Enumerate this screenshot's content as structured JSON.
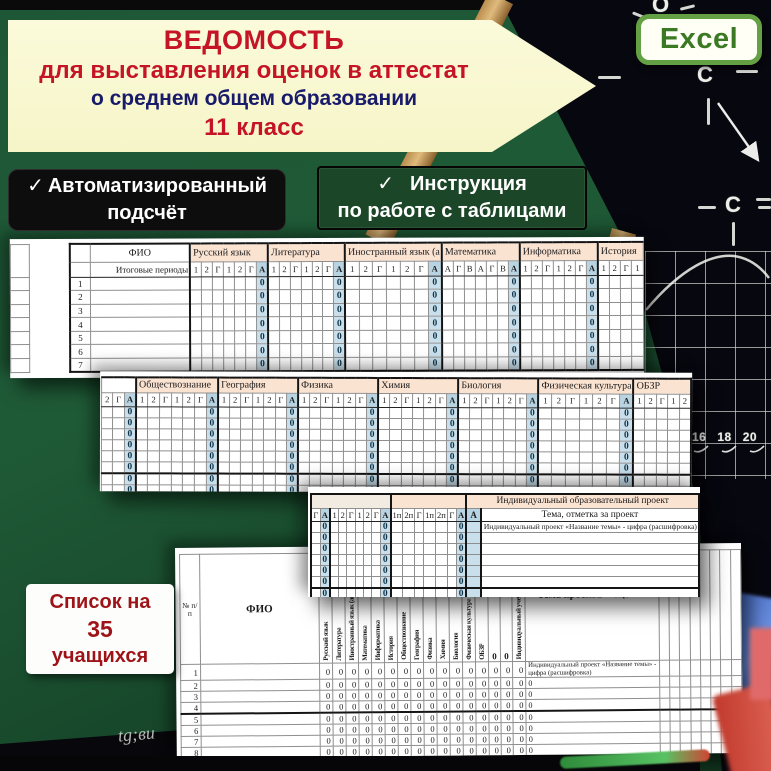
{
  "banner": {
    "line1": "ВЕДОМОСТЬ",
    "line2": "для выставления оценок в аттестат",
    "line3": "о среднем общем образовании",
    "line4": "11 класс"
  },
  "excel_badge": {
    "label": "Excel"
  },
  "feature_badges": {
    "auto": {
      "check": "✓",
      "line1": "Автоматизированный",
      "line2": "подсчёт"
    },
    "instruction": {
      "check": "✓",
      "line1": "Инструкция",
      "line2": "по работе с таблицами"
    }
  },
  "list_badge": {
    "line1": "Список на",
    "line2": "35",
    "line3": "учащихся"
  },
  "chalk": {
    "atom_o": "O",
    "atom_c1": "C",
    "atom_c2": "C",
    "axis_numbers": [
      "16",
      "18",
      "20"
    ],
    "handwriting": "tg;ви"
  },
  "sheet1": {
    "fio": "ФИО",
    "periods": "Итоговые периоды",
    "zero": "0",
    "groups": [
      {
        "name": "Русский язык",
        "cols": [
          "1",
          "2",
          "Г",
          "1",
          "2",
          "Г",
          "А"
        ]
      },
      {
        "name": "Литература",
        "cols": [
          "1",
          "2",
          "Г",
          "1",
          "2",
          "Г",
          "А"
        ]
      },
      {
        "name": "Иностранный язык (а",
        "cols": [
          "1",
          "2",
          "Г",
          "1",
          "2",
          "Г",
          "А"
        ]
      },
      {
        "name": "Математика",
        "cols": [
          "А",
          "Г",
          "В",
          "А",
          "Г",
          "В",
          "А"
        ]
      },
      {
        "name": "Информатика",
        "cols": [
          "1",
          "2",
          "Г",
          "1",
          "2",
          "Г",
          "А"
        ]
      },
      {
        "name": "История",
        "cols": [
          "1",
          "2",
          "Г",
          "1"
        ]
      }
    ],
    "row_numbers": [
      "1",
      "2",
      "3",
      "4",
      "5",
      "6",
      "7"
    ]
  },
  "sheet2": {
    "lead_cols": [
      "2",
      "Г",
      "А"
    ],
    "zero": "0",
    "rows": 8,
    "thick_after_row": 6,
    "groups": [
      {
        "name": "Обществознание",
        "cols": [
          "1",
          "2",
          "Г",
          "1",
          "2",
          "Г",
          "А"
        ]
      },
      {
        "name": "География",
        "cols": [
          "1",
          "2",
          "Г",
          "1",
          "2",
          "Г",
          "А"
        ]
      },
      {
        "name": "Физика",
        "cols": [
          "1",
          "2",
          "Г",
          "1",
          "2",
          "Г",
          "А"
        ]
      },
      {
        "name": "Химия",
        "cols": [
          "1",
          "2",
          "Г",
          "1",
          "2",
          "Г",
          "А"
        ]
      },
      {
        "name": "Биология",
        "cols": [
          "1",
          "2",
          "Г",
          "1",
          "2",
          "Г",
          "А"
        ]
      },
      {
        "name": "Физическая культура",
        "cols": [
          "1",
          "2",
          "Г",
          "1",
          "2",
          "Г",
          "А"
        ]
      },
      {
        "name": "ОБЗР",
        "cols": [
          "1",
          "2",
          "Г",
          "1",
          "2"
        ]
      }
    ]
  },
  "sheet3": {
    "section_title": "Индивидуальный образовательный проект",
    "lead_cols": [
      "Г",
      "А"
    ],
    "groups": [
      {
        "cols": [
          "1",
          "2",
          "Г",
          "1",
          "2",
          "Г",
          "А"
        ]
      },
      {
        "cols": [
          "1п",
          "2п",
          "Г",
          "1п",
          "2п",
          "Г",
          "А"
        ]
      }
    ],
    "avg_col": "А",
    "theme_header": "Тема, отметка за проект",
    "row1_text": "Индивидуальный проект «Название темы» - цифра (расшифровка)",
    "zero": "0",
    "rows": 8,
    "thick_after_row": 6
  },
  "sheet4": {
    "num_header": "№ п/п",
    "fio_header": "ФИО",
    "vertical_headers": [
      "Русский язык",
      "Литература",
      "Иностранный язык (ан",
      "Математика",
      "Информатика",
      "История",
      "Обществознание",
      "География",
      "Физика",
      "Химия",
      "Биология",
      "Физическая культура",
      "ОБЗР",
      "0",
      "0",
      "Индивидуальный учебн"
    ],
    "theme_header": "Тема проекта + оценка",
    "row1_theme": "Индивидуальный проект «Название темы» - цифра (расшифровка)",
    "other_theme": "0",
    "zero": "0",
    "row_numbers": [
      "1",
      "2",
      "3",
      "4",
      "5",
      "6",
      "7",
      "8",
      "9"
    ],
    "thick_after_row": 4,
    "trailing_cols": 8
  },
  "colors": {
    "board_green": "#1d5132",
    "banner_bg": "#fafad2",
    "banner_red": "#c41425",
    "banner_navy": "#181a6a",
    "excel_green": "#63a144",
    "excel_text": "#3b7a22",
    "badge_black": "#0d0d0d",
    "badge_green": "#1b4627",
    "list_badge_red": "#9e1318",
    "sheet_peach": "#fbe3d2",
    "sheet_blue": "#b8d4e3",
    "sheet_blue_light": "#c9dfeb",
    "wood": "#c79a5b"
  }
}
